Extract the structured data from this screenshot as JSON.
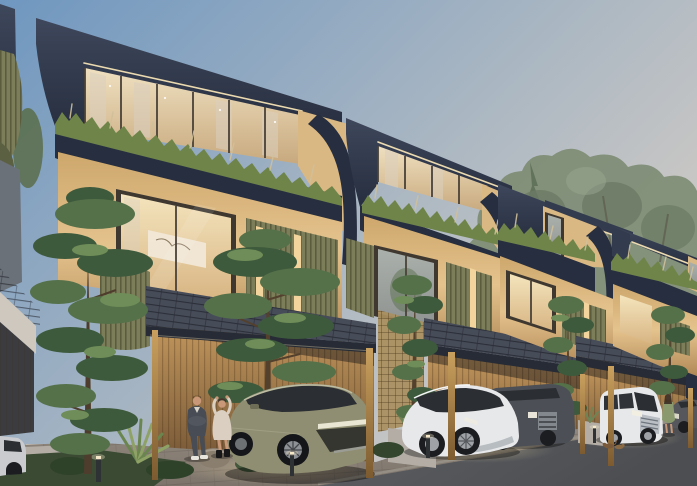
{
  "scene": {
    "title": "Row of modern tropical townhouses at dusk",
    "time_of_day": "dusk",
    "buildings": {
      "count_visible": 4,
      "stories": 3,
      "features": "dark navy roof volumes with lit window bands, rooftop planter bands of grasses, warm beige walls, olive-green louvre screens with glowing slots, curved corner fins, shingled carport canopies on brass posts, timber-slat carport walls"
    },
    "vehicles": [
      "olive-green SUV in first carport",
      "white crossover in second carport",
      "dark grey SUV beside it",
      "white luxury van in third carport",
      "dark car partially visible at right edge",
      "silver car partially visible at left edge"
    ],
    "people": [
      "man in dark suit with arms crossed",
      "woman in cream dress adjusting her hair",
      "woman in green dress near the far carport"
    ],
    "animals": "two cats on the street",
    "landscape": "two tall foreground pines, small trees between carports, tropical planting bed with rock, bollard path lights, hazy tree canopy behind the roofline",
    "ground": "paver driveways meeting an asphalt street"
  },
  "colors": {
    "sky_top": "#6f97c0",
    "sky_mid": "#a9b6c2",
    "sky_warm": "#d8cfc6",
    "navy_dark": "#262e3f",
    "navy": "#333b4e",
    "navy_light": "#3e475b",
    "beige_wall": "#cda76c",
    "beige_lit": "#e5c38d",
    "beige_deep": "#b08856",
    "glass_warm": "#e9d2ac",
    "curtain": "#f3e7d3",
    "frame_dark": "#4a4239",
    "olive_louver": "#7c7e59",
    "olive_dark": "#5c6042",
    "grass_green": "#6e8449",
    "grass_dry": "#cfc09a",
    "shingle": "#40455200",
    "shingle_base": "#404552",
    "wood_wall": "#c79a5f",
    "wood_dark": "#6e5132",
    "bronze": "#ab854b",
    "concrete": "#b3ada5",
    "paver": "#8b8178",
    "asphalt": "#56585c",
    "pine_dark": "#3e5a3c",
    "pine_mid": "#55714a",
    "pine_light": "#6f8d58",
    "trunk": "#53412e",
    "bg_tree": "#7e8c74",
    "suv_olive": "#8f8e72",
    "car_white": "#e7e8ea",
    "car_gray": "#4c4f55",
    "car_silver": "#c9cbce",
    "skin": "#c89878",
    "suit": "#474c55",
    "dress_cream": "#dacfc0",
    "dress_green": "#8a9a6e",
    "light_warm": "#f5e3b5"
  }
}
